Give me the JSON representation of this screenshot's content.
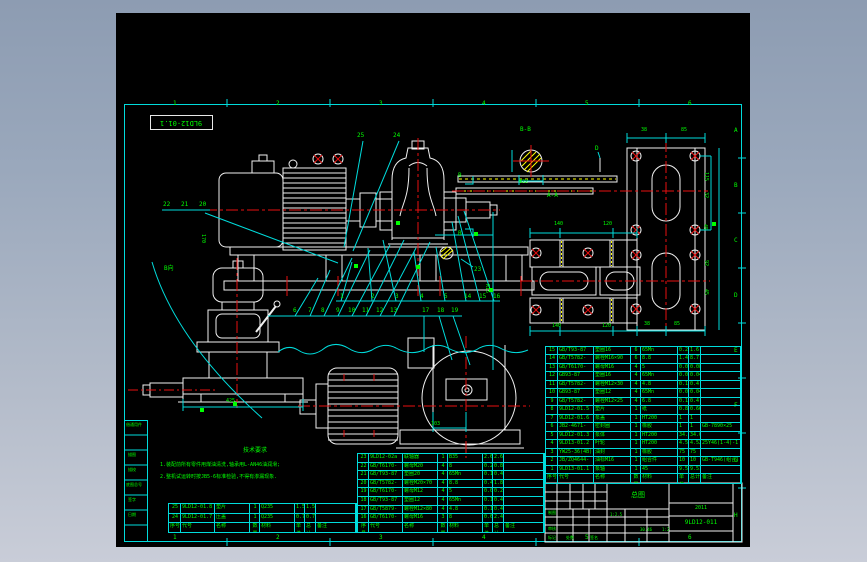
{
  "colors": {
    "background_frame": "#9aa8bc",
    "canvas": "#000000",
    "border": "#00dcdc",
    "lines": "#f0f0f0",
    "centerline": "#e81010",
    "text": "#00ff00",
    "hatch": "#ffff00"
  },
  "frame": {
    "ref_box": "9LD12-01.1"
  },
  "zones": {
    "top": [
      {
        "t": "1",
        "x": 173,
        "y": 101
      },
      {
        "t": "2",
        "x": 276,
        "y": 101
      },
      {
        "t": "3",
        "x": 379,
        "y": 101
      },
      {
        "t": "4",
        "x": 482,
        "y": 101
      },
      {
        "t": "5",
        "x": 585,
        "y": 101
      },
      {
        "t": "6",
        "x": 688,
        "y": 101
      }
    ],
    "bottom": [
      {
        "t": "1",
        "x": 173,
        "y": 535
      },
      {
        "t": "2",
        "x": 276,
        "y": 535
      },
      {
        "t": "3",
        "x": 379,
        "y": 535
      },
      {
        "t": "4",
        "x": 482,
        "y": 535
      },
      {
        "t": "5",
        "x": 585,
        "y": 535
      },
      {
        "t": "6",
        "x": 688,
        "y": 535
      }
    ],
    "right": [
      {
        "t": "A",
        "x": 734,
        "y": 128
      },
      {
        "t": "B",
        "x": 734,
        "y": 183
      },
      {
        "t": "C",
        "x": 734,
        "y": 238
      },
      {
        "t": "D",
        "x": 734,
        "y": 293
      },
      {
        "t": "E",
        "x": 734,
        "y": 348
      },
      {
        "t": "F",
        "x": 734,
        "y": 403
      },
      {
        "t": "G",
        "x": 734,
        "y": 458
      },
      {
        "t": "H",
        "x": 734,
        "y": 513
      }
    ]
  },
  "marks": [
    {
      "t": "B-B",
      "x": 520,
      "y": 127
    },
    {
      "t": "A-A",
      "x": 547,
      "y": 193
    },
    {
      "t": "D",
      "x": 595,
      "y": 146
    },
    {
      "t": "B",
      "x": 458,
      "y": 173
    },
    {
      "t": "B",
      "x": 458,
      "y": 231
    },
    {
      "t": "B向",
      "x": 164,
      "y": 266
    }
  ],
  "balloons": [
    {
      "t": "25",
      "x": 357,
      "y": 133
    },
    {
      "t": "24",
      "x": 393,
      "y": 133
    },
    {
      "t": "22",
      "x": 163,
      "y": 202
    },
    {
      "t": "21",
      "x": 181,
      "y": 202
    },
    {
      "t": "20",
      "x": 199,
      "y": 202
    },
    {
      "t": "23",
      "x": 474,
      "y": 267
    },
    {
      "t": "1",
      "x": 340,
      "y": 294
    },
    {
      "t": "2",
      "x": 371,
      "y": 294
    },
    {
      "t": "3",
      "x": 395,
      "y": 294
    },
    {
      "t": "4",
      "x": 420,
      "y": 294
    },
    {
      "t": "5",
      "x": 444,
      "y": 294
    },
    {
      "t": "14",
      "x": 464,
      "y": 294
    },
    {
      "t": "15",
      "x": 479,
      "y": 294
    },
    {
      "t": "16",
      "x": 493,
      "y": 294
    },
    {
      "t": "6",
      "x": 293,
      "y": 308
    },
    {
      "t": "7",
      "x": 308,
      "y": 308
    },
    {
      "t": "8",
      "x": 321,
      "y": 308
    },
    {
      "t": "9",
      "x": 336,
      "y": 308
    },
    {
      "t": "10",
      "x": 348,
      "y": 308
    },
    {
      "t": "11",
      "x": 362,
      "y": 308
    },
    {
      "t": "12",
      "x": 376,
      "y": 308
    },
    {
      "t": "13",
      "x": 390,
      "y": 308
    },
    {
      "t": "17",
      "x": 422,
      "y": 308
    },
    {
      "t": "18",
      "x": 437,
      "y": 308
    },
    {
      "t": "19",
      "x": 451,
      "y": 308
    }
  ],
  "dims": [
    {
      "t": "38",
      "x": 641,
      "y": 128
    },
    {
      "t": "85",
      "x": 681,
      "y": 128
    },
    {
      "t": "115",
      "x": 708,
      "y": 172,
      "r": 90
    },
    {
      "t": "32",
      "x": 708,
      "y": 192,
      "r": 90
    },
    {
      "t": "140",
      "x": 554,
      "y": 222
    },
    {
      "t": "120",
      "x": 603,
      "y": 222
    },
    {
      "t": "140",
      "x": 552,
      "y": 324
    },
    {
      "t": "120",
      "x": 602,
      "y": 324
    },
    {
      "t": "38",
      "x": 644,
      "y": 322
    },
    {
      "t": "85",
      "x": 674,
      "y": 322
    },
    {
      "t": "45",
      "x": 707,
      "y": 224,
      "r": 90
    },
    {
      "t": "92",
      "x": 708,
      "y": 260,
      "r": 90
    },
    {
      "t": "45",
      "x": 708,
      "y": 289,
      "r": 90
    },
    {
      "t": "Φ22",
      "x": 519,
      "y": 180
    },
    {
      "t": "103",
      "x": 431,
      "y": 422
    },
    {
      "t": "425",
      "x": 226,
      "y": 399
    },
    {
      "t": "170",
      "x": 205,
      "y": 234,
      "r": 90
    },
    {
      "t": "R15",
      "x": 489,
      "y": 284,
      "r": 90
    }
  ],
  "tech": {
    "title": "技术要求",
    "line1": "1.装配前所有零件用煤油清洗,轴承用L-AN46油润滑;",
    "line2": "2.整机试运转时按JB5-6标准检验,不得有渗漏现象."
  },
  "bom": {
    "header_rows": [
      [
        "序号",
        "代号",
        "名称",
        "数量",
        "材料",
        "单件",
        "总计",
        "备注"
      ]
    ],
    "right_rows": [
      [
        "15",
        "GB/T93-87",
        "垫圈16",
        "6",
        "65Mn",
        "0.2",
        "1.6",
        ""
      ],
      [
        "14",
        "GB/T5782-2000",
        "螺栓M16×90",
        "6",
        "8.8",
        "1.45",
        "8.7",
        ""
      ],
      [
        "13",
        "GB/T6170-2000",
        "螺母M16",
        "4",
        "5",
        "0.02",
        "0.08",
        ""
      ],
      [
        "12",
        "GB93-87",
        "垫圈16",
        "4",
        "65Mn",
        "0.01",
        "0.04",
        ""
      ],
      [
        "11",
        "GB/T5782-2000",
        "螺栓M12×30",
        "4",
        "4.8",
        "0.1",
        "0.4",
        ""
      ],
      [
        "10",
        "GB93-87",
        "垫圈12",
        "4",
        "65Mn",
        "0.01",
        "0.04",
        ""
      ],
      [
        "9",
        "GB/T5782-2000",
        "螺栓M12×25",
        "4",
        "6.8",
        "0.1",
        "0.4",
        ""
      ],
      [
        "8",
        "9LD12-01.5",
        "垫片",
        "1",
        "纸",
        "0.84",
        "0.66",
        ""
      ],
      [
        "7",
        "9LD12-01.6",
        "泵盖",
        "1",
        "HT200",
        "1",
        "1",
        ""
      ],
      [
        "6",
        "JB2-4671-F(橡胶)",
        "密封圈",
        "1",
        "橡胶",
        "1",
        "1",
        "GB-7890×25"
      ],
      [
        "5",
        "9LD12-01.3",
        "泵体",
        "1",
        "HT200",
        "34.0",
        "34.0",
        ""
      ],
      [
        "4",
        "9LD13-01.2",
        "叶轮",
        "1",
        "HT200",
        "4.52",
        "4.52",
        "25Y46(1-4)-1"
      ],
      [
        "3",
        "YW25-36(4B)",
        "油封",
        "1",
        "橡胶",
        "75",
        "75",
        ""
      ],
      [
        "2",
        "JB/ZQ4644-74",
        "油标M16",
        "1",
        "组合件",
        "10",
        "10",
        "GB-T946(组合)"
      ],
      [
        "1",
        "9LD13-01.1",
        "泵轴",
        "1",
        "45",
        "9.51",
        "9.51",
        ""
      ]
    ],
    "left_rows": [
      [
        "23",
        "9LD12-02a",
        "联轴器",
        "1",
        "B35",
        "2.63",
        "2.63",
        ""
      ],
      [
        "22",
        "GB/T6170-2000",
        "螺母M20",
        "4",
        "8",
        "0.2",
        "0.8",
        ""
      ],
      [
        "21",
        "GB/T93-87",
        "垫圈20",
        "4",
        "65Mn",
        "0.1",
        "0.4",
        ""
      ],
      [
        "20",
        "GB/T5782-2000",
        "螺栓M20×70",
        "4",
        "8.8",
        "0.46",
        "1.84",
        ""
      ],
      [
        "19",
        "GB/T6170-2000",
        "螺母M12",
        "4",
        "5",
        "0.07",
        "0.28",
        ""
      ],
      [
        "18",
        "GB/T93-87",
        "垫圈12",
        "4",
        "65Mn",
        "0.1",
        "0.4",
        ""
      ],
      [
        "17",
        "GB/T5879-2000",
        "螺栓M12×80",
        "4",
        "4.8",
        "0.1",
        "0.4",
        ""
      ],
      [
        "16",
        "GB/T6170-2000",
        "螺母M16",
        "3",
        "8",
        "0.6",
        "2.4",
        ""
      ]
    ],
    "extra_rows": [
      [
        "25",
        "9LD12-01.8",
        "垫片",
        "1",
        "Q235",
        "1.5",
        "1.5",
        ""
      ],
      [
        "24",
        "9LD12-01.7",
        "压盖",
        "1",
        "Q235",
        "0.7",
        "0.7",
        ""
      ]
    ]
  },
  "titleblock": {
    "title": "总图",
    "note": "2011",
    "drawing_no": "9LD12-011",
    "frags": [
      {
        "t": "制图",
        "x": 548,
        "y": 511
      },
      {
        "t": "审核",
        "x": 548,
        "y": 527
      },
      {
        "t": "1:2.5",
        "x": 610,
        "y": 513
      },
      {
        "t": "30.46",
        "x": 640,
        "y": 528
      },
      {
        "t": "1:2",
        "x": 662,
        "y": 528
      },
      {
        "t": "标记",
        "x": 548,
        "y": 536
      },
      {
        "t": "处数",
        "x": 566,
        "y": 536
      },
      {
        "t": "签名",
        "x": 590,
        "y": 536
      }
    ]
  },
  "margin": {
    "items": [
      {
        "t": "借通用件",
        "x": 126,
        "y": 423
      },
      {
        "t": "描图",
        "x": 128,
        "y": 453
      },
      {
        "t": "描校",
        "x": 128,
        "y": 468
      },
      {
        "t": "底图总号",
        "x": 126,
        "y": 483
      },
      {
        "t": "签字",
        "x": 128,
        "y": 498
      },
      {
        "t": "日期",
        "x": 128,
        "y": 513
      }
    ]
  }
}
